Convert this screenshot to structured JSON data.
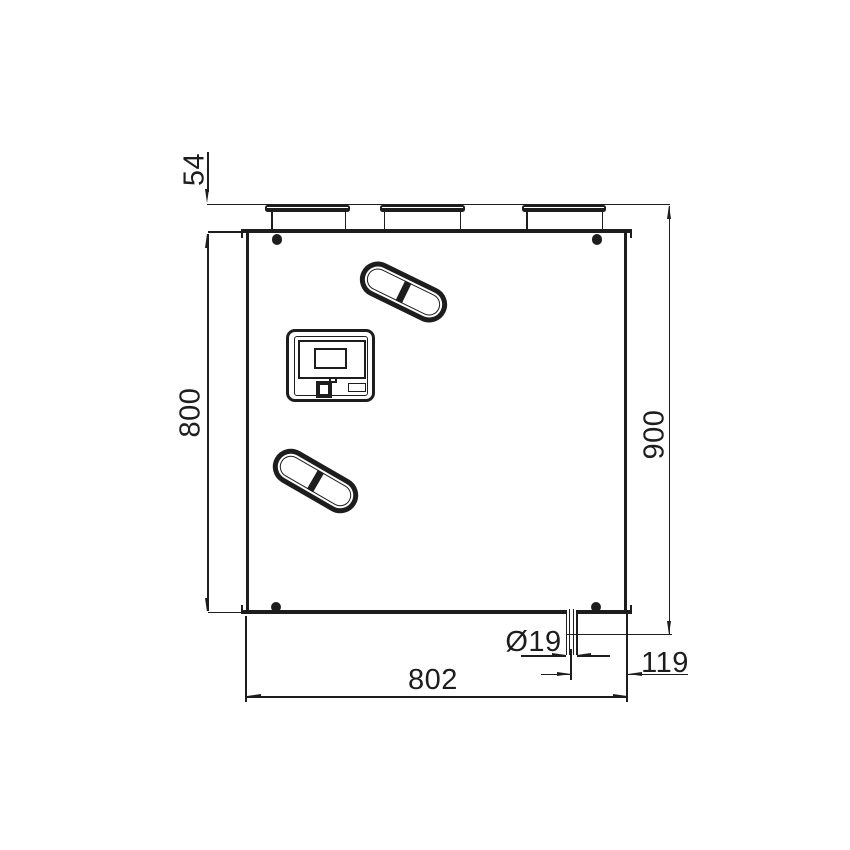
{
  "page": {
    "background": "#ffffff",
    "line_color": "#1d1d1d"
  },
  "drawing": {
    "title": "Heat recovery ventilation unit - dimensioned side view",
    "unit": {
      "duct_collars": 3,
      "oval_handles": 2,
      "corner_screws": 4,
      "has_control_display": true,
      "has_drain_pipe": true
    },
    "dimensions": {
      "collar_height_mm": "54",
      "body_height_mm": "800",
      "total_height_mm": "900",
      "body_width_mm": "802",
      "drain_offset_mm": "119",
      "drain_diameter_mm": "Ø19"
    }
  }
}
